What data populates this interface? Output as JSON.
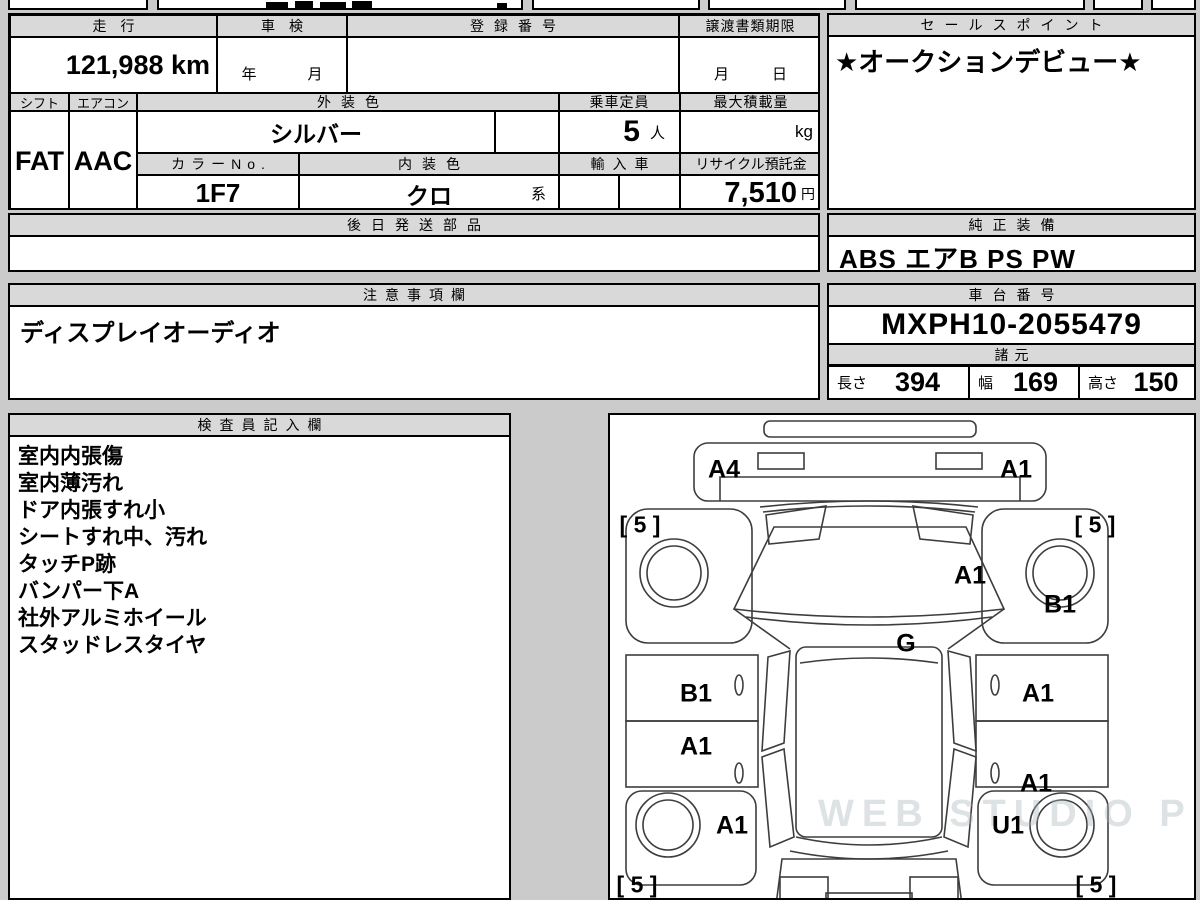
{
  "sheet": {
    "mileage": {
      "label": "走行",
      "value": "121,988 km"
    },
    "shaken": {
      "label": "車検",
      "value": "年　月"
    },
    "registration_no": {
      "label": "登録番号",
      "value": ""
    },
    "transfer_deadline": {
      "label": "譲渡書類期限",
      "value": "月　日"
    },
    "sales_point": {
      "label": "セールスポイント",
      "value": "★オークションデビュー★"
    },
    "shift": {
      "label": "シフト",
      "value": "FAT"
    },
    "aircon": {
      "label": "エアコン",
      "value": "AAC"
    },
    "exterior_color": {
      "label": "外装色",
      "value": "シルバー"
    },
    "capacity": {
      "label": "乗車定員",
      "value": "5",
      "unit": "人"
    },
    "max_load": {
      "label": "最大積載量",
      "value": "",
      "unit": "kg"
    },
    "color_no": {
      "label": "カラーNo.",
      "value": "1F7"
    },
    "interior_color": {
      "label": "内装色",
      "value": "クロ",
      "suffix": "系"
    },
    "imported": {
      "label": "輸入車",
      "value": ""
    },
    "recycle_deposit": {
      "label": "リサイクル預託金",
      "value": "7,510",
      "unit": "円"
    },
    "later_parts": {
      "label": "後日発送部品",
      "value": ""
    },
    "genuine_equipment": {
      "label": "純正装備",
      "value": "ABS エアB PS PW"
    },
    "cautions": {
      "label": "注意事項欄",
      "value": "ディスプレイオーディオ"
    },
    "chassis_no": {
      "label": "車台番号",
      "value": "MXPH10-2055479"
    },
    "dimensions": {
      "label": "諸元",
      "items": [
        {
          "label": "長さ",
          "value": "394"
        },
        {
          "label": "幅",
          "value": "169"
        },
        {
          "label": "高さ",
          "value": "150"
        }
      ]
    },
    "inspector_notes": {
      "label": "検査員記入欄",
      "items": [
        "室内内張傷",
        "室内薄汚れ",
        "ドア内張すれ小",
        "シートすれ中、汚れ",
        "タッチP跡",
        "バンパー下A",
        "社外アルミホイール",
        "スタッドレスタイヤ"
      ]
    }
  },
  "diagram": {
    "watermark": "WEB STUDIO PRO",
    "labels": [
      {
        "text": "A4",
        "x": 114,
        "y": 55
      },
      {
        "text": "A1",
        "x": 406,
        "y": 55
      },
      {
        "text": "[ 5 ]",
        "x": 30,
        "y": 110,
        "kind": "tire"
      },
      {
        "text": "[ 5 ]",
        "x": 485,
        "y": 110,
        "kind": "tire"
      },
      {
        "text": "A1",
        "x": 360,
        "y": 161
      },
      {
        "text": "B1",
        "x": 450,
        "y": 190
      },
      {
        "text": "G",
        "x": 296,
        "y": 229
      },
      {
        "text": "B1",
        "x": 86,
        "y": 279
      },
      {
        "text": "A1",
        "x": 428,
        "y": 279
      },
      {
        "text": "A1",
        "x": 86,
        "y": 332
      },
      {
        "text": "A1",
        "x": 426,
        "y": 369
      },
      {
        "text": "A1",
        "x": 122,
        "y": 411
      },
      {
        "text": "U1",
        "x": 398,
        "y": 411
      },
      {
        "text": "[ 5 ]",
        "x": 27,
        "y": 470,
        "kind": "tire"
      },
      {
        "text": "[ 5 ]",
        "x": 486,
        "y": 470,
        "kind": "tire"
      }
    ]
  }
}
